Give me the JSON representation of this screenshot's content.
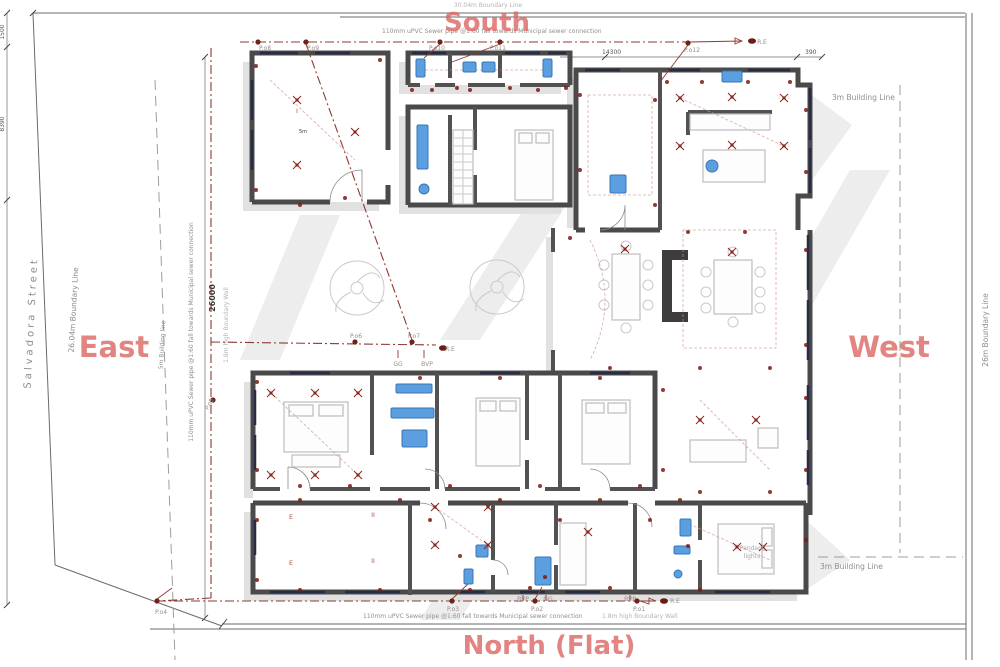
{
  "colors": {
    "compass": "#dc6a66",
    "sewer_line": "#8d3a30",
    "electrical": "#7a1a12",
    "fixture_blue": "#5b9fe0",
    "fixture_blue_stroke": "#3a76b5",
    "wall": "#4a4a4a",
    "shadow": "#e1e1e1",
    "gray_text": "#8f8f8f"
  },
  "compass": {
    "south": "South",
    "east": "East",
    "west": "West",
    "north": "North (Flat)"
  },
  "notes": {
    "sewer_top": "110mm uPVC Sewer pipe @1:60 fall towards Municipal sewer connection",
    "sewer_bottom": "110mm uPVC Sewer pipe @1:60 fall towards Municipal sewer connection",
    "sewer_left": "110mm uPVC Sewer pipe @1:60 fall towards Municipal sewer connection",
    "boundary_left": "26.04m Boundary Line",
    "boundary_right": "26m Boundary Line",
    "boundary_top_partial": "30.04m Boundary Line",
    "building_line_left": "5m Building line",
    "building_line_right_top": "3m Building Line",
    "building_line_right_bottom": "3m Building Line",
    "street": "Salvadora Street",
    "wall_left": "1.8m high Boundary Wall",
    "wall_bottom": "1.8m high Boundary Wall",
    "pendant_1": "Pendant",
    "pendant_2": "lights"
  },
  "dims": {
    "d_1500": "1500",
    "d_8390": "8390",
    "d_26000": "26000",
    "d_14300": "14300",
    "d_390": "390"
  },
  "point_labels": [
    {
      "x": 265,
      "y": 50,
      "t": "P.o8"
    },
    {
      "x": 313,
      "y": 50,
      "t": "P.o9"
    },
    {
      "x": 437,
      "y": 50,
      "t": "P.o10"
    },
    {
      "x": 498,
      "y": 50,
      "t": "P.o11"
    },
    {
      "x": 692,
      "y": 52,
      "t": "P.o12"
    },
    {
      "x": 762,
      "y": 44,
      "t": "R.E"
    },
    {
      "x": 356,
      "y": 338,
      "t": "P.o6"
    },
    {
      "x": 414,
      "y": 338,
      "t": "P.o7"
    },
    {
      "x": 450,
      "y": 351,
      "t": "R.E"
    },
    {
      "x": 398,
      "y": 366,
      "t": "GG"
    },
    {
      "x": 427,
      "y": 366,
      "t": "BVP"
    },
    {
      "x": 211,
      "y": 405,
      "t": "P.o5",
      "rot": -60
    },
    {
      "x": 161,
      "y": 614,
      "t": "P.o4"
    },
    {
      "x": 453,
      "y": 611,
      "t": "P.o3"
    },
    {
      "x": 523,
      "y": 601,
      "t": "BVP"
    },
    {
      "x": 548,
      "y": 601,
      "t": "GG"
    },
    {
      "x": 537,
      "y": 611,
      "t": "P.o2"
    },
    {
      "x": 630,
      "y": 601,
      "t": "BVP"
    },
    {
      "x": 639,
      "y": 611,
      "t": "P.o1"
    },
    {
      "x": 675,
      "y": 603,
      "t": "R.E"
    }
  ],
  "room_marks": [
    {
      "x": 291,
      "y": 519,
      "t": "E"
    },
    {
      "x": 373,
      "y": 517,
      "t": "II"
    },
    {
      "x": 291,
      "y": 565,
      "t": "E"
    },
    {
      "x": 373,
      "y": 563,
      "t": "II"
    },
    {
      "x": 297,
      "y": 113,
      "t": "I"
    },
    {
      "x": 303,
      "y": 133,
      "t": "5m",
      "dark": true
    }
  ],
  "plan": {
    "junction_dots": [
      [
        258,
        42
      ],
      [
        306,
        42
      ],
      [
        440,
        42
      ],
      [
        500,
        42
      ],
      [
        688,
        43
      ],
      [
        355,
        342
      ],
      [
        412,
        342
      ],
      [
        213,
        400
      ],
      [
        157,
        601
      ],
      [
        452,
        601
      ],
      [
        535,
        601
      ],
      [
        637,
        601
      ]
    ],
    "re_dots": [
      [
        752,
        41
      ],
      [
        443,
        348
      ],
      [
        664,
        601
      ]
    ],
    "outlet_dots": [
      [
        256,
        66
      ],
      [
        380,
        60
      ],
      [
        256,
        190
      ],
      [
        345,
        198
      ],
      [
        300,
        205
      ],
      [
        412,
        90
      ],
      [
        432,
        90
      ],
      [
        457,
        88
      ],
      [
        470,
        90
      ],
      [
        510,
        88
      ],
      [
        538,
        90
      ],
      [
        566,
        88
      ],
      [
        580,
        95
      ],
      [
        655,
        100
      ],
      [
        580,
        170
      ],
      [
        655,
        205
      ],
      [
        667,
        82
      ],
      [
        702,
        82
      ],
      [
        748,
        82
      ],
      [
        790,
        82
      ],
      [
        806,
        110
      ],
      [
        806,
        172
      ],
      [
        688,
        232
      ],
      [
        745,
        232
      ],
      [
        570,
        238
      ],
      [
        610,
        368
      ],
      [
        700,
        368
      ],
      [
        770,
        368
      ],
      [
        806,
        250
      ],
      [
        806,
        345
      ],
      [
        663,
        390
      ],
      [
        663,
        470
      ],
      [
        806,
        398
      ],
      [
        806,
        470
      ],
      [
        700,
        492
      ],
      [
        770,
        492
      ],
      [
        257,
        382
      ],
      [
        257,
        470
      ],
      [
        300,
        486
      ],
      [
        350,
        486
      ],
      [
        420,
        378
      ],
      [
        450,
        486
      ],
      [
        500,
        378
      ],
      [
        540,
        486
      ],
      [
        600,
        378
      ],
      [
        640,
        486
      ],
      [
        300,
        500
      ],
      [
        400,
        500
      ],
      [
        500,
        500
      ],
      [
        600,
        500
      ],
      [
        680,
        500
      ],
      [
        257,
        520
      ],
      [
        257,
        580
      ],
      [
        300,
        590
      ],
      [
        380,
        590
      ],
      [
        430,
        520
      ],
      [
        470,
        590
      ],
      [
        530,
        588
      ],
      [
        560,
        520
      ],
      [
        610,
        588
      ],
      [
        650,
        520
      ],
      [
        700,
        590
      ],
      [
        806,
        540
      ],
      [
        460,
        556
      ],
      [
        545,
        577
      ],
      [
        688,
        546
      ]
    ],
    "light_symbols": [
      [
        625,
        249
      ],
      [
        732,
        252
      ],
      [
        680,
        98
      ],
      [
        732,
        97
      ],
      [
        784,
        98
      ],
      [
        680,
        146
      ],
      [
        732,
        145
      ],
      [
        784,
        146
      ],
      [
        297,
        100
      ],
      [
        297,
        165
      ],
      [
        355,
        132
      ],
      [
        271,
        393
      ],
      [
        315,
        393
      ],
      [
        358,
        393
      ],
      [
        271,
        475
      ],
      [
        315,
        475
      ],
      [
        358,
        475
      ],
      [
        435,
        507
      ],
      [
        488,
        507
      ],
      [
        435,
        545
      ],
      [
        488,
        545
      ],
      [
        588,
        532
      ],
      [
        700,
        420
      ],
      [
        756,
        420
      ],
      [
        737,
        547
      ],
      [
        763,
        547
      ]
    ],
    "fixtures": [
      {
        "s": "r",
        "x": 416,
        "y": 59,
        "w": 9,
        "h": 18
      },
      {
        "s": "r",
        "x": 543,
        "y": 59,
        "w": 9,
        "h": 18
      },
      {
        "s": "r",
        "x": 463,
        "y": 62,
        "w": 13,
        "h": 10
      },
      {
        "s": "r",
        "x": 482,
        "y": 62,
        "w": 13,
        "h": 10
      },
      {
        "s": "r",
        "x": 722,
        "y": 71,
        "w": 20,
        "h": 11
      },
      {
        "s": "r",
        "x": 610,
        "y": 175,
        "w": 16,
        "h": 18
      },
      {
        "s": "r",
        "x": 417,
        "y": 125,
        "w": 11,
        "h": 44
      },
      {
        "s": "r",
        "x": 396,
        "y": 384,
        "w": 36,
        "h": 9
      },
      {
        "s": "r",
        "x": 391,
        "y": 408,
        "w": 43,
        "h": 10
      },
      {
        "s": "r",
        "x": 402,
        "y": 430,
        "w": 25,
        "h": 17
      },
      {
        "s": "r",
        "x": 535,
        "y": 557,
        "w": 16,
        "h": 28
      },
      {
        "s": "r",
        "x": 680,
        "y": 519,
        "w": 11,
        "h": 17
      },
      {
        "s": "r",
        "x": 674,
        "y": 546,
        "w": 16,
        "h": 8
      },
      {
        "s": "r",
        "x": 476,
        "y": 545,
        "w": 12,
        "h": 12
      },
      {
        "s": "r",
        "x": 464,
        "y": 569,
        "w": 9,
        "h": 15
      },
      {
        "s": "c",
        "x": 712,
        "y": 166,
        "r": 6
      },
      {
        "s": "c",
        "x": 424,
        "y": 189,
        "r": 5
      },
      {
        "s": "c",
        "x": 678,
        "y": 574,
        "r": 4
      }
    ]
  }
}
